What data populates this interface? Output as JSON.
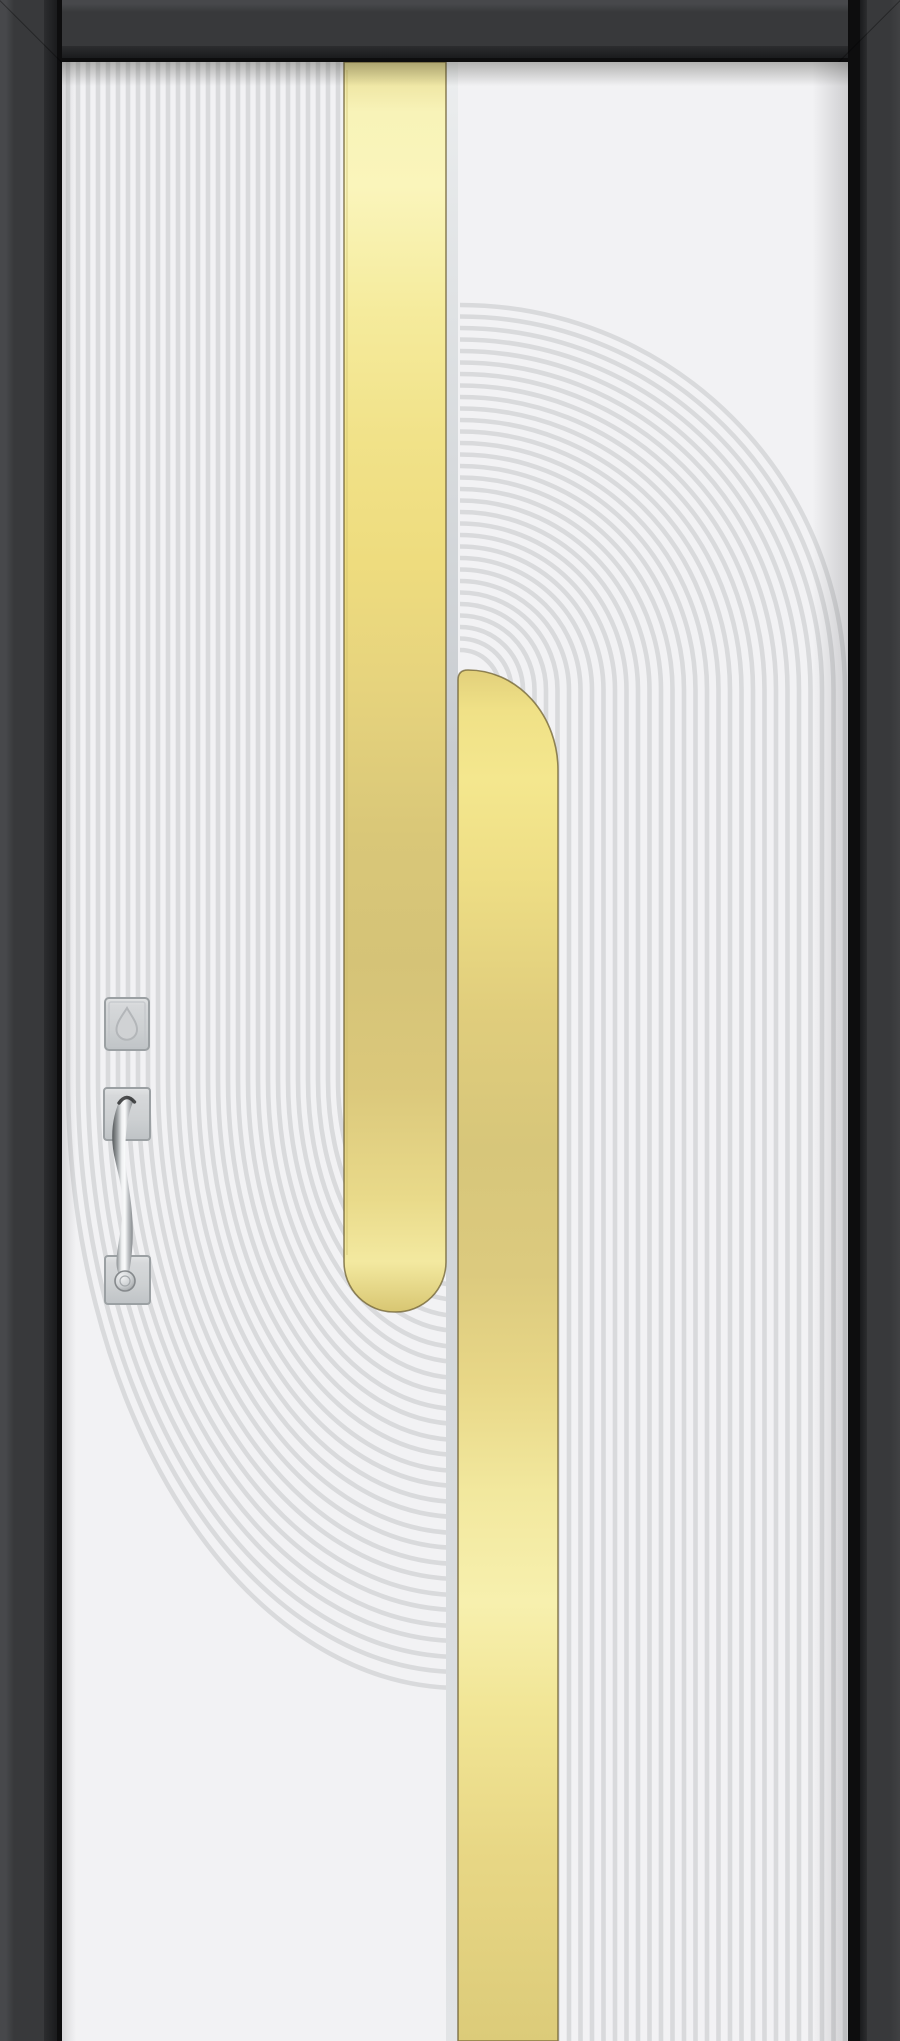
{
  "scene": {
    "description": "Front-view product photo of a modern white entry door in a charcoal frame; fluted relief pattern of vertical lines flowing into concentric arcs, two brushed-gold vertical inlay stripes, satin-chrome smart lock and pull handle",
    "canvas": {
      "width": 900,
      "height": 2041
    }
  },
  "frame": {
    "outer_color": "#38393b",
    "outer_highlight": "#47484b",
    "bevel_mid": "#2c2d2f",
    "bevel_dark": "#1a1b1d",
    "inner_line_color": "#0d0d0e"
  },
  "leaf": {
    "base_color": "#f2f2f4",
    "ridge_color": "#d9dadc",
    "ridge_width": 4.6,
    "top_shadow": "rgba(30,30,22,0.30)",
    "side_shadow": "rgba(25,25,30,0.14)"
  },
  "patterns": {
    "left_flutes": {
      "count": 28,
      "x_start": 68,
      "spacing": 10,
      "top_y": 62,
      "turn_y": 1080,
      "center_x": 460,
      "ry_ratio": 1.55
    },
    "right_arches": {
      "count": 31,
      "center_x": 460,
      "center_y": 690,
      "r_start": 40,
      "r_step": 11.5,
      "bottom_y": 2041
    }
  },
  "gold_stripes": {
    "edge_dark": "#6d6034",
    "edge_light": "#c8b96a",
    "divider": {
      "x": 446,
      "width": 12,
      "stops": [
        [
          "0",
          "#eceeef"
        ],
        [
          "0.35",
          "#c8ccd0"
        ],
        [
          "0.7",
          "#d6d9dc"
        ],
        [
          "1",
          "#e2e4e6"
        ]
      ]
    },
    "left_bar": {
      "x": 344,
      "y": 62,
      "width": 102,
      "bottom_y": 1312,
      "corner_radius": 50,
      "stops": [
        [
          "0",
          "#e8dd96"
        ],
        [
          "0.04",
          "#f8f3b8"
        ],
        [
          "0.1",
          "#faf5bb"
        ],
        [
          "0.2",
          "#f5eb9c"
        ],
        [
          "0.3",
          "#f1e289"
        ],
        [
          "0.4",
          "#eedc7e"
        ],
        [
          "0.5",
          "#e6d37d"
        ],
        [
          "0.62",
          "#d9c778"
        ],
        [
          "0.72",
          "#d5c377"
        ],
        [
          "0.82",
          "#dbc87b"
        ],
        [
          "0.91",
          "#e9da8a"
        ],
        [
          "0.96",
          "#f3e9a0"
        ],
        [
          "1",
          "#d8c672"
        ]
      ]
    },
    "right_bar": {
      "x": 458,
      "top_y": 670,
      "width": 100,
      "bottom_y": 2041,
      "corner_rx": 90,
      "corner_ry": 100,
      "stops": [
        [
          "0",
          "#e2d07b"
        ],
        [
          "0.03",
          "#f0e187"
        ],
        [
          "0.08",
          "#f4e78e"
        ],
        [
          "0.15",
          "#eede85"
        ],
        [
          "0.25",
          "#e0cd7c"
        ],
        [
          "0.35",
          "#d7c67a"
        ],
        [
          "0.44",
          "#dcca7e"
        ],
        [
          "0.52",
          "#e8d787"
        ],
        [
          "0.6",
          "#f2e89e"
        ],
        [
          "0.68",
          "#f7f0ae"
        ],
        [
          "0.76",
          "#f1e595"
        ],
        [
          "0.86",
          "#e8d785"
        ],
        [
          "1",
          "#dccb79"
        ]
      ]
    }
  },
  "hardware": {
    "finish": "satin-chrome",
    "plate_edge": "#9ba0a3",
    "plate_stops": [
      [
        "0",
        "#e2e4e5"
      ],
      [
        "0.15",
        "#d6d8da"
      ],
      [
        "0.6",
        "#cdd0d2"
      ],
      [
        "1",
        "#bfc3c6"
      ]
    ],
    "grip_stops": [
      [
        "0",
        "#55585b"
      ],
      [
        "0.25",
        "#9ea2a5"
      ],
      [
        "0.45",
        "#eff1f2"
      ],
      [
        "0.6",
        "#fafbfb"
      ],
      [
        "0.75",
        "#c2c5c8"
      ],
      [
        "1",
        "#7d8184"
      ]
    ],
    "knob_stops": [
      [
        "0",
        "#f2f3f4"
      ],
      [
        "0.5",
        "#cfd2d4"
      ],
      [
        "1",
        "#8f9396"
      ]
    ],
    "smart_lock": {
      "x": 105,
      "y": 998,
      "width": 44,
      "height": 52,
      "emblem": "teardrop"
    },
    "handle": {
      "top_plate": {
        "x": 104,
        "y": 1088,
        "width": 46,
        "height": 52
      },
      "bottom_plate": {
        "x": 105,
        "y": 1256,
        "width": 45,
        "height": 48
      },
      "knob": {
        "cx": 125,
        "cy": 1281,
        "r": 10
      }
    }
  }
}
